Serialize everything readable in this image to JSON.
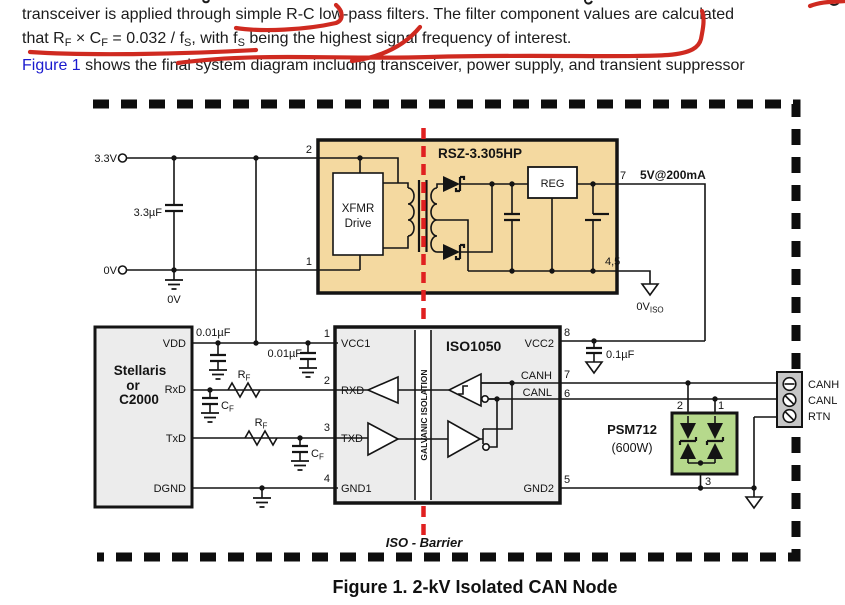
{
  "text": {
    "para1": {
      "r0": "transceiver is applied through simple R-C low-pass filters. The filter component values are calculated"
    },
    "para2": {
      "r0": "that R",
      "r1": "F",
      "r2": " × C",
      "r3": "F",
      "r4": " = 0.032 / f",
      "r5": "S",
      "r6": ", with f",
      "r7": "S",
      "r8": " being the highest signal frequency of interest."
    },
    "para3": {
      "r0": "Figure 1",
      "r1": " shows the final system diagram including transceiver, power supply, and transient suppressor"
    },
    "caption": "Figure 1. 2-kV Isolated CAN Node"
  },
  "diagram": {
    "supply": {
      "v33": "3.3V",
      "v0": "0V",
      "cap": "3.3µF",
      "gnd0": "0V",
      "pin2": "2",
      "pin1": "1"
    },
    "rsz": {
      "title": "RSZ-3.305HP",
      "xfmr1": "XFMR",
      "xfmr2": "Drive",
      "reg": "REG",
      "pin7": "7",
      "out": "5V@200mA",
      "pin45": "4,5",
      "gnd_iso": "0V",
      "gnd_iso_sub": "ISO"
    },
    "mcu": {
      "l1": "Stellaris",
      "l2": "or",
      "l3": "C2000",
      "vdd": "VDD",
      "rxd": "RxD",
      "txd": "TxD",
      "dgnd": "DGND"
    },
    "filters": {
      "r": "R",
      "c": "C",
      "f_sub": "F",
      "cap001": "0.01µF",
      "cap01": "0.1µF"
    },
    "iso": {
      "title": "ISO1050",
      "band": "GALVANIC ISOLATION",
      "vcc1": "VCC1",
      "rxd": "RXD",
      "txd": "TXD",
      "gnd1": "GND1",
      "vcc2": "VCC2",
      "canh": "CANH",
      "canl": "CANL",
      "gnd2": "GND2",
      "p1": "1",
      "p2": "2",
      "p3": "3",
      "p4": "4",
      "p5": "5",
      "p6": "6",
      "p7": "7",
      "p8": "8"
    },
    "tvs": {
      "name": "PSM712",
      "rating": "(600W)",
      "p1": "1",
      "p2": "2",
      "p3": "3"
    },
    "conn": {
      "canh": "CANH",
      "canl": "CANL",
      "rtn": "RTN"
    },
    "barrier": "ISO - Barrier"
  },
  "colors": {
    "pen_red": "#cf2a20",
    "iso_red": "#e02020",
    "module_fill": "#f4d9a0",
    "block_fill": "#ececec",
    "tvs_fill": "#b6d98c",
    "conn_fill": "#c6c6c6",
    "link_blue": "#1a1ace",
    "navy": "#1f3864"
  }
}
